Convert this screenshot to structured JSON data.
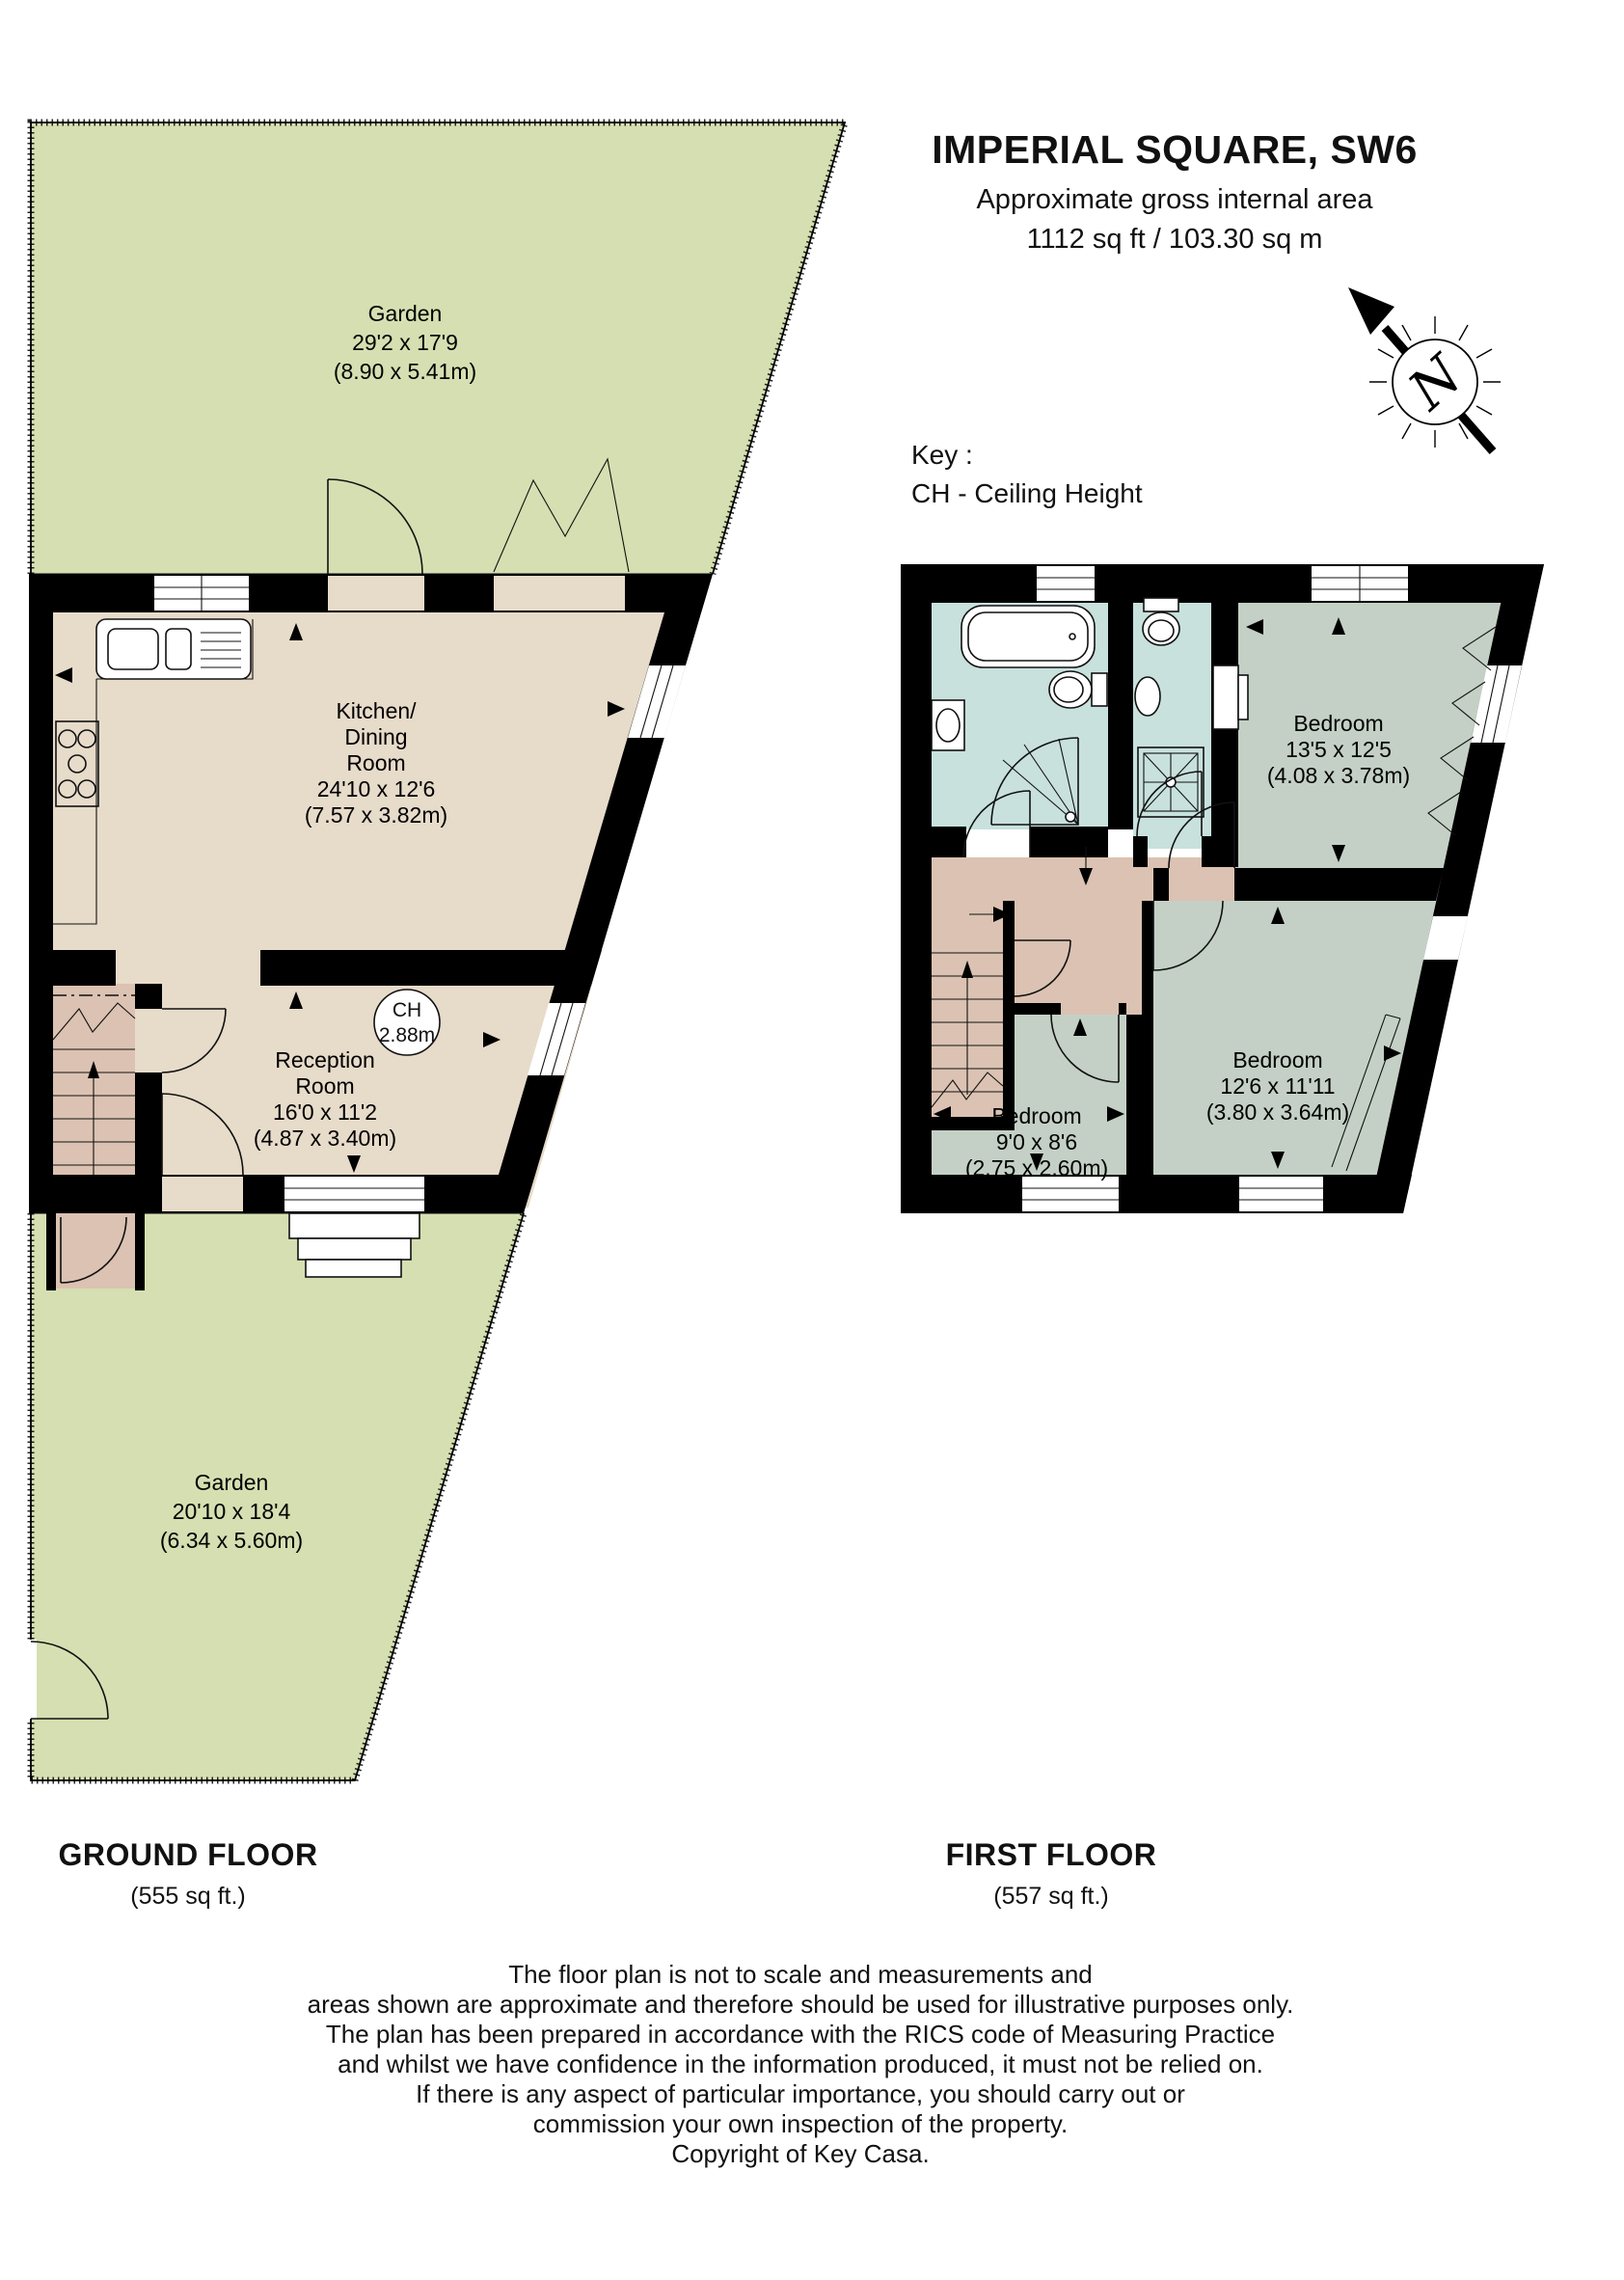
{
  "header": {
    "title": "IMPERIAL SQUARE, SW6",
    "subtitle": "Approximate gross internal area",
    "area": "1112 sq ft / 103.30 sq m"
  },
  "key": {
    "title": "Key :",
    "entry": "CH - Ceiling Height"
  },
  "compass": {
    "north_label": "N"
  },
  "ground_floor": {
    "title": "GROUND FLOOR",
    "area": "(555 sq ft.)",
    "garden_top": {
      "lines": [
        "Garden",
        "29'2 x 17'9",
        "(8.90 x 5.41m)"
      ]
    },
    "kitchen_dining": {
      "lines": [
        "Kitchen/",
        "Dining",
        "Room",
        "24'10 x 12'6",
        "(7.57 x 3.82m)"
      ]
    },
    "ceiling_height": {
      "lines": [
        "CH",
        "2.88m"
      ]
    },
    "reception": {
      "lines": [
        "Reception",
        "Room",
        "16'0 x 11'2",
        "(4.87 x 3.40m)"
      ]
    },
    "garden_bottom": {
      "lines": [
        "Garden",
        "20'10 x 18'4",
        "(6.34 x 5.60m)"
      ]
    }
  },
  "first_floor": {
    "title": "FIRST FLOOR",
    "area": "(557 sq ft.)",
    "bedroom_1": {
      "lines": [
        "Bedroom",
        "13'5 x 12'5",
        "(4.08 x 3.78m)"
      ]
    },
    "bedroom_2": {
      "lines": [
        "Bedroom",
        "12'6 x 11'11",
        "(3.80 x 3.64m)"
      ]
    },
    "bedroom_3": {
      "lines": [
        "Bedroom",
        "9'0 x 8'6",
        "(2.75 x 2.60m)"
      ]
    }
  },
  "disclaimer": {
    "lines": [
      "The floor plan is not to scale and measurements and",
      "areas shown are approximate and therefore should be used for illustrative purposes only.",
      "The plan has been prepared in accordance with the RICS code of Measuring Practice",
      "and whilst we have confidence in the information produced, it must not be relied on.",
      "If there is any aspect of particular importance, you should carry out or",
      "commission your own inspection of the property.",
      "Copyright of Key Casa."
    ]
  },
  "colors": {
    "garden": "#d5dfb1",
    "room": "#e7dbca",
    "hall": "#dbc2b2",
    "bathroom": "#c8e1dd",
    "bedroom": "#c4d0c5",
    "wall": "#000000"
  }
}
